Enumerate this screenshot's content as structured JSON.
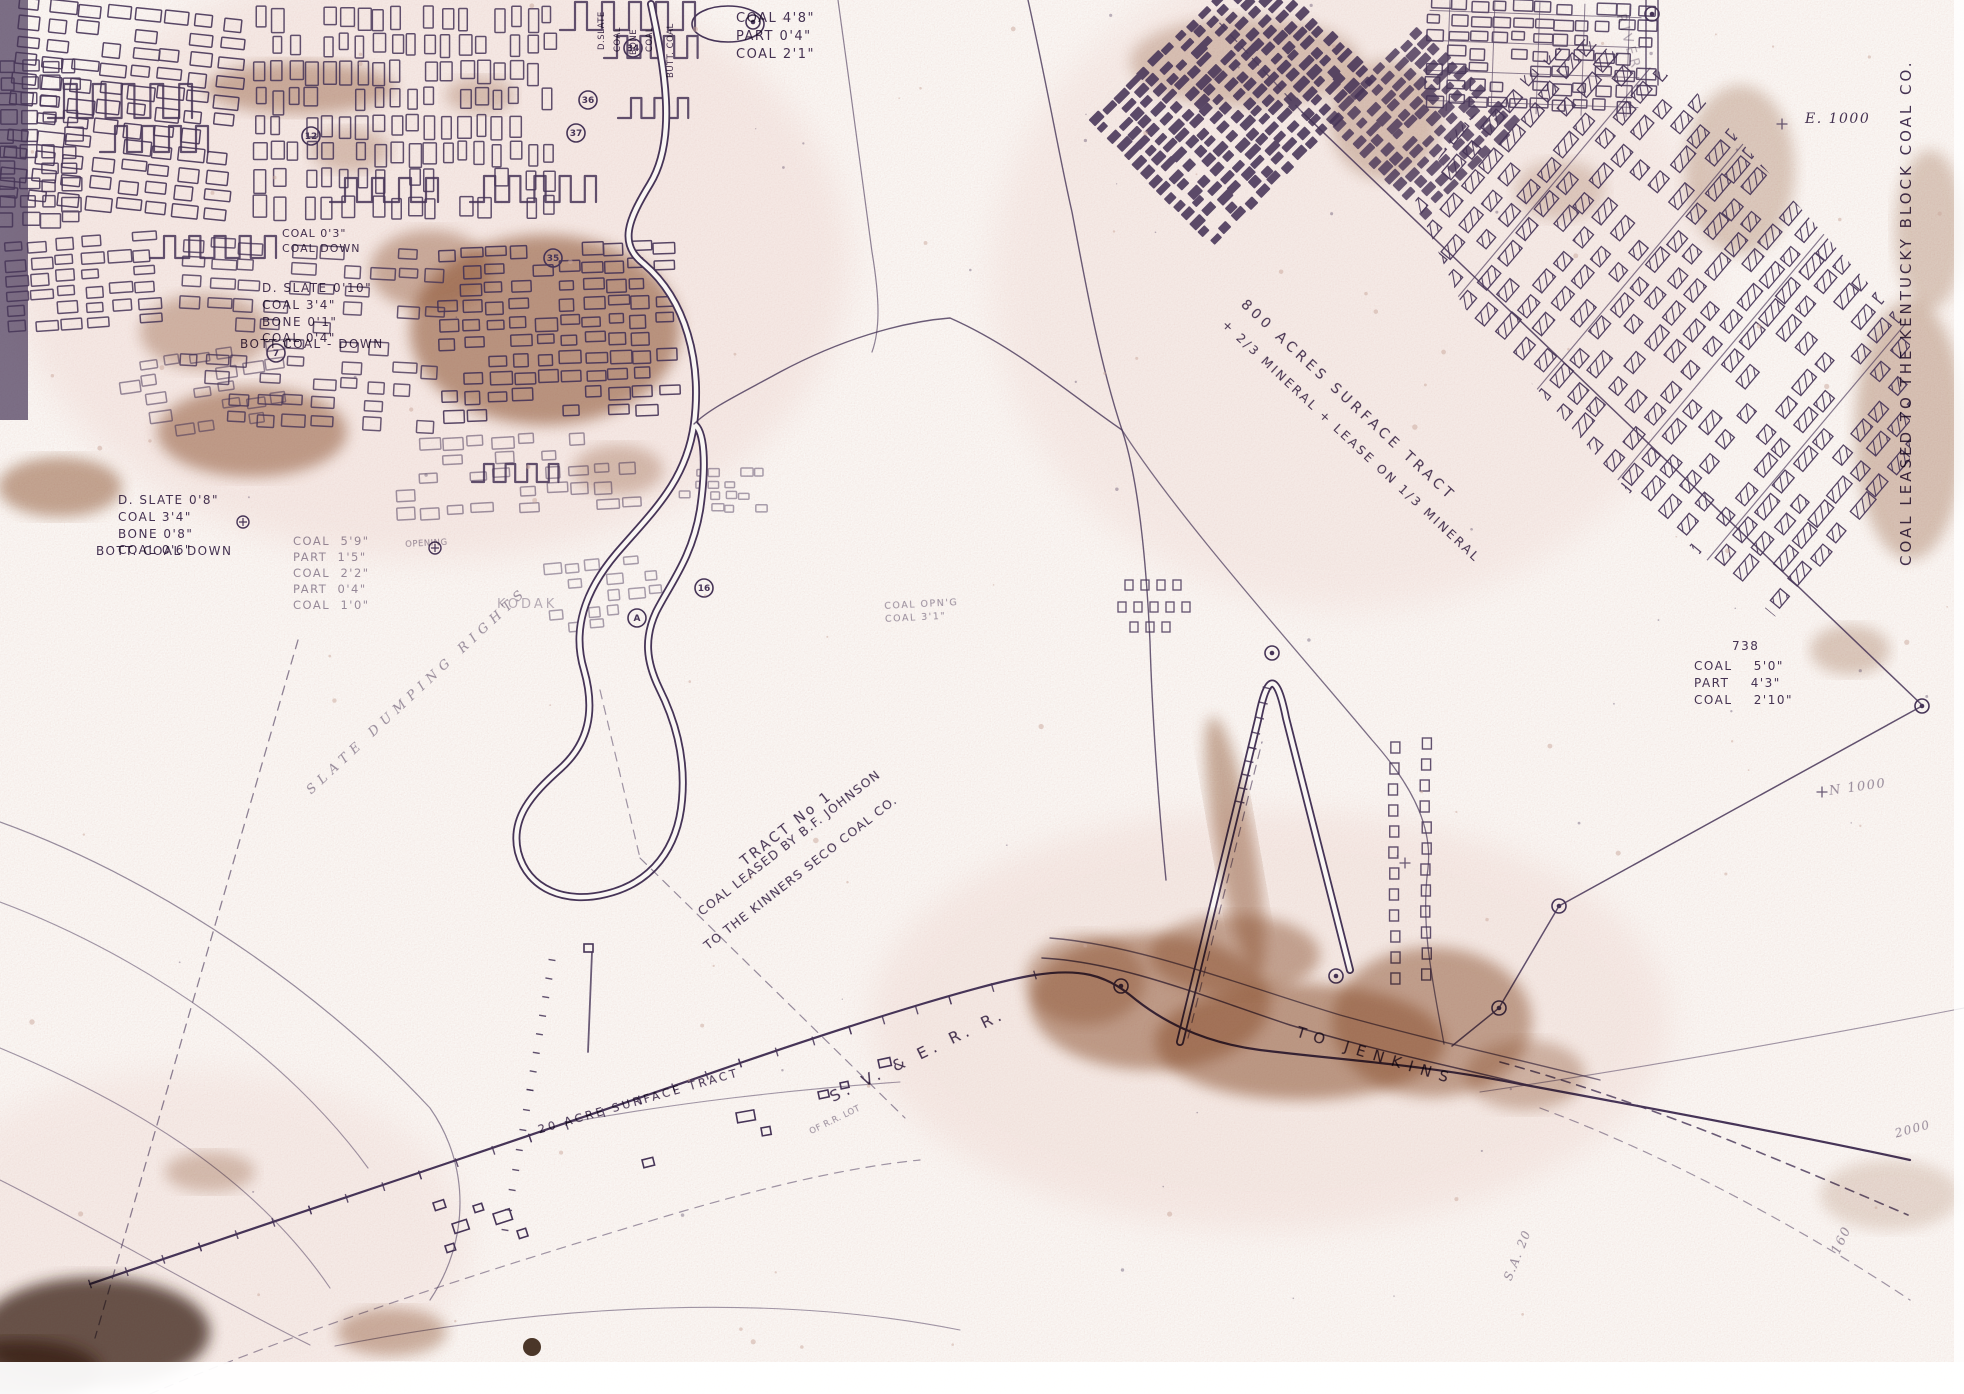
{
  "colors": {
    "ink": "#463457",
    "ink_faint": "#9a87ab",
    "stain": "#8f5631",
    "stain_dark": "#3a2414",
    "paper": "#faf7f4",
    "blotch": "#f1ded9",
    "speckle": "#d9b9b2"
  },
  "labels": {
    "seam_top": "COAL 4'8\"\nPART 0'4\"\nCOAL 2'1\"",
    "vert_words": [
      "D.SLATE",
      "COAL",
      "BONE",
      "COAL",
      "BUTT. COAL"
    ],
    "coal_down_note": "COAL 0'3\"\nCOAL DOWN",
    "seam_upper_left": "D. SLATE 0'10\"\nCOAL 3'4\"\nBONE 0'1\"\nCOAL 0'4\"",
    "bott_coal_1": "BOTT COAL - DOWN",
    "seam_left": "D. SLATE 0'8\"\nCOAL 3'4\"\nBONE 0'8\"\nCOAL 0'6\"",
    "bott_coal_2": "BOTT. COAL DOWN",
    "seam_mid": "COAL  5'9\"\nPART  1'5\"\nCOAL  2'2\"\nPART  0'4\"\nCOAL  1'0\"",
    "opening_note": "OPENING",
    "coal_opng": "COAL OPN'G\nCOAL 3'1\"",
    "tract1_line1": "TRACT No 1",
    "tract1_line2": "COAL LEASED BY B.F. JOHNSON",
    "tract1_line3": "TO THE KINNERS SECO COAL CO.",
    "acres_line1": "800 ACRES SURFACE TRACT",
    "acres_line2": "+ 2/3 MINERAL + LEASE ON 1/3 MINERAL",
    "kentucky_block": "COAL LEASED TO THE KENTUCKY BLOCK COAL CO.",
    "e1000": "E. 1000",
    "n1000": "N 1000",
    "v2000": "2000",
    "v160": "160",
    "sa20": "S.A. 20",
    "station_738": "738",
    "seam_right": "COAL    5'0\"\nPART    4'3\"\nCOAL    2'10\"",
    "svrr": "S. V. & E. R. R.",
    "rr_lot": "OF R.R. LOT",
    "to_jenkins": "TO JENKINS",
    "acre20": "20 ACRE SURFACE TRACT",
    "slate_rights": "SLATE DUMPING RIGHTS",
    "faint_word": "KODAK",
    "river_word": "RIVER"
  },
  "markers": {
    "circled_numbers": [
      {
        "v": "34",
        "x": 633,
        "y": 48
      },
      {
        "v": "36",
        "x": 588,
        "y": 100
      },
      {
        "v": "37",
        "x": 576,
        "y": 133
      },
      {
        "v": "35",
        "x": 553,
        "y": 258
      },
      {
        "v": "12",
        "x": 311,
        "y": 136
      },
      {
        "v": "7",
        "x": 276,
        "y": 353
      },
      {
        "v": "16",
        "x": 704,
        "y": 588
      },
      {
        "v": "A",
        "x": 637,
        "y": 618
      }
    ],
    "survey_stations": [
      [
        753,
        22
      ],
      [
        1272,
        653
      ],
      [
        1559,
        906
      ],
      [
        1499,
        1008
      ],
      [
        1336,
        976
      ],
      [
        1121,
        986
      ],
      [
        1922,
        706
      ],
      [
        1652,
        14
      ]
    ],
    "monuments": [
      [
        243,
        522
      ],
      [
        435,
        548
      ]
    ]
  }
}
